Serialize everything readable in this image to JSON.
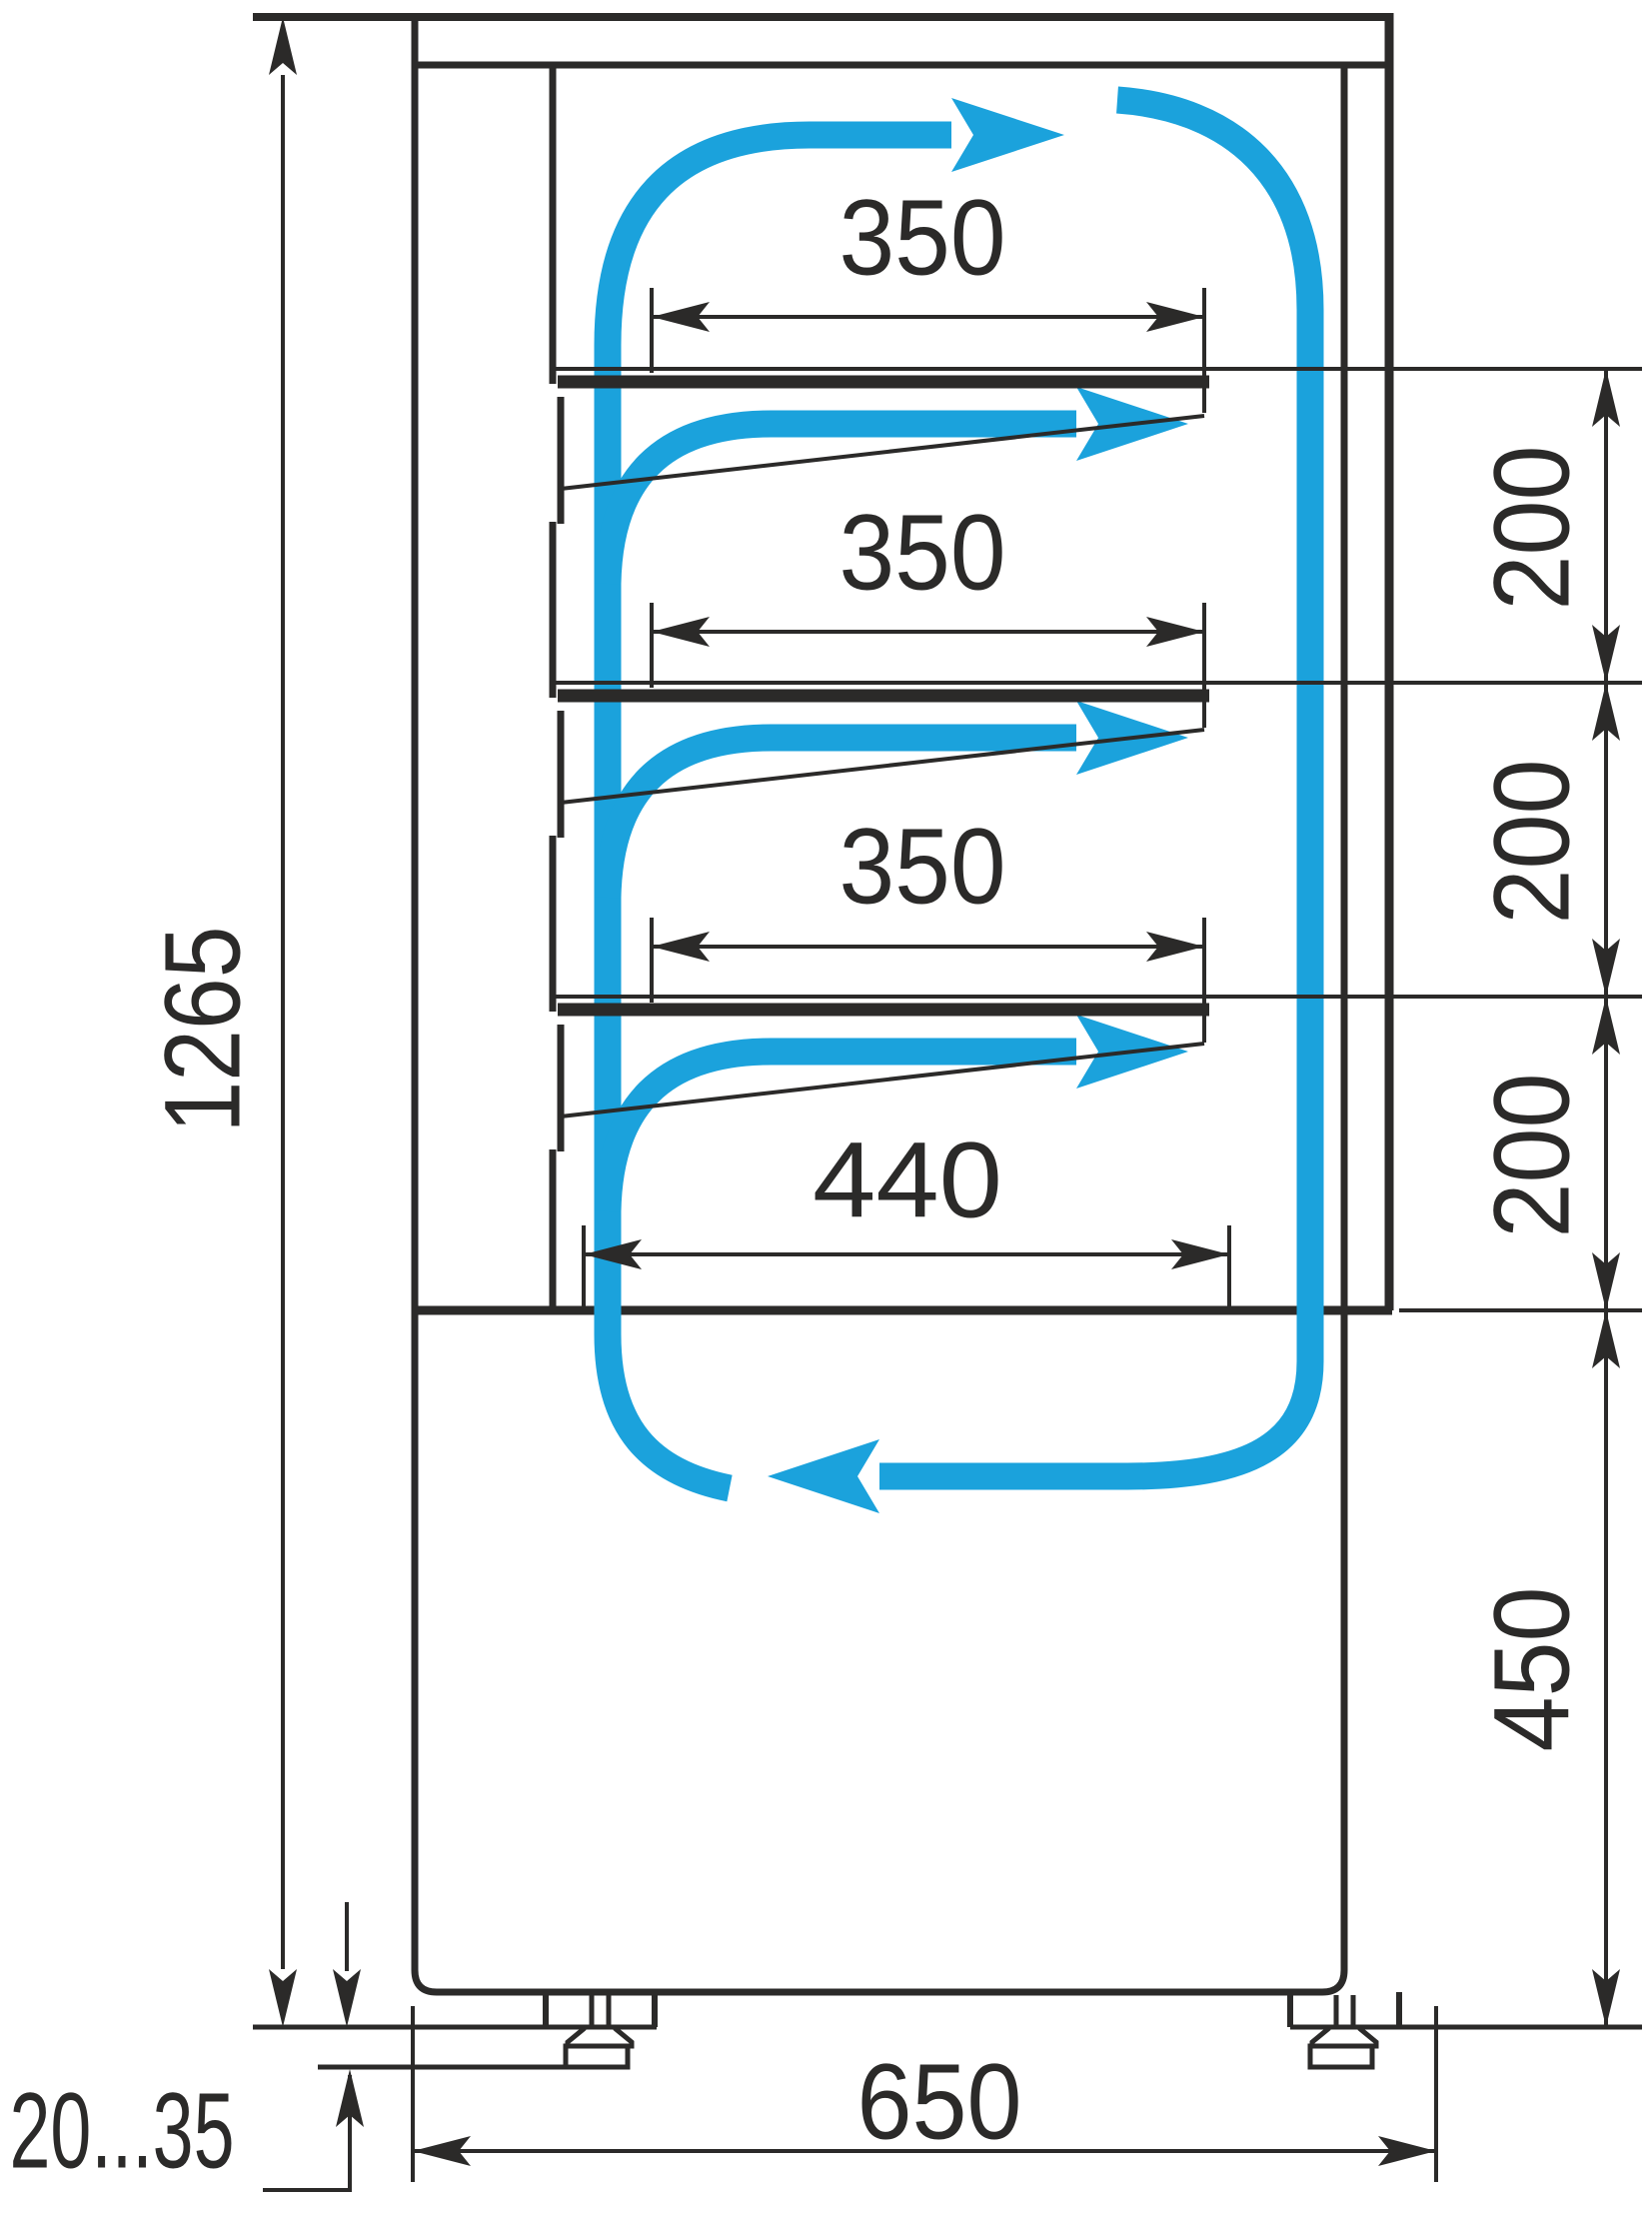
{
  "colors": {
    "line": "#2b2a29",
    "airflow": "#1ba2dc",
    "background": "#ffffff"
  },
  "dimensions": {
    "overall_height": "1265",
    "shelf_width_top": "350",
    "shelf_width_middle": "350",
    "shelf_width_lower": "350",
    "bottom_shelf_width": "440",
    "shelf_gap_1": "200",
    "shelf_gap_2": "200",
    "shelf_gap_3": "200",
    "base_height": "450",
    "depth": "650",
    "foot_height_range": "20...35"
  },
  "icons": {
    "airflow_arrow": "airflow-arrow-icon",
    "dimension_arrow": "dimension-arrow-icon"
  }
}
